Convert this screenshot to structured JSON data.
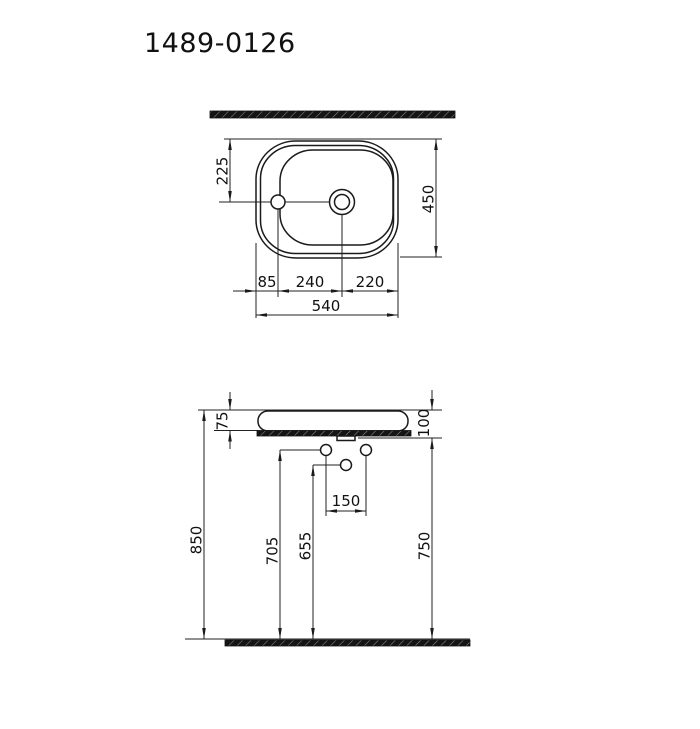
{
  "title": "1489-0126",
  "top_view": {
    "faucet_center_from_back": "225",
    "depth": "450",
    "edge_to_faucet": "85",
    "faucet_to_drain": "240",
    "drain_to_edge": "220",
    "width": "540"
  },
  "side_view": {
    "basin_above_counter": "75",
    "rim_to_counter_bottom": "100",
    "supply_hole_spacing": "150",
    "rim_height": "850",
    "supply_height": "705",
    "drain_height": "655",
    "counter_bottom_height": "750"
  },
  "colors": {
    "line": "#1a1a1a",
    "background": "#ffffff"
  }
}
